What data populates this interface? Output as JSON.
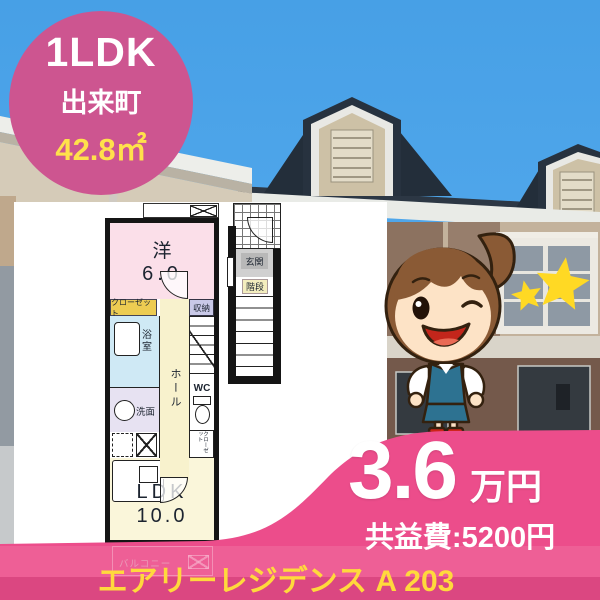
{
  "badge": {
    "layout_type": "1LDK",
    "location": "出来町",
    "area": "42.8㎡"
  },
  "floorplan": {
    "western_room": {
      "label": "洋",
      "size": "6.0"
    },
    "closet_label": "クローゼット",
    "storage_label": "収納",
    "bath_label": "浴室",
    "washroom_label": "洗面",
    "hall_label": "ホール",
    "wc_label": "WC",
    "mini_closet_label": "クローゼット",
    "entrance_label": "玄関",
    "stairs_label": "階段",
    "ldk": {
      "label": "LDK",
      "size": "10.0"
    },
    "balcony_label": "バルコニー"
  },
  "price": {
    "rent": "3.6",
    "unit": "万円",
    "common_fee": "共益費:5200円"
  },
  "property_name": "エアリーレジデンス A 203",
  "colors": {
    "badge_pink": "#cd5590",
    "wave_pink": "#ec4d8b",
    "name_yellow": "#ffd93c",
    "area_yellow": "#ffe14b",
    "star_yellow": "#ffd924",
    "sky_blue": "#4aa2e8",
    "room_pink": "#fbdfe9",
    "ldk_cream": "#faf6da",
    "hall_cream": "#f8f2cd",
    "bath_blue": "#cfe9f5",
    "lavender": "#e7e2f2",
    "closet_yellow": "#edcc52"
  }
}
